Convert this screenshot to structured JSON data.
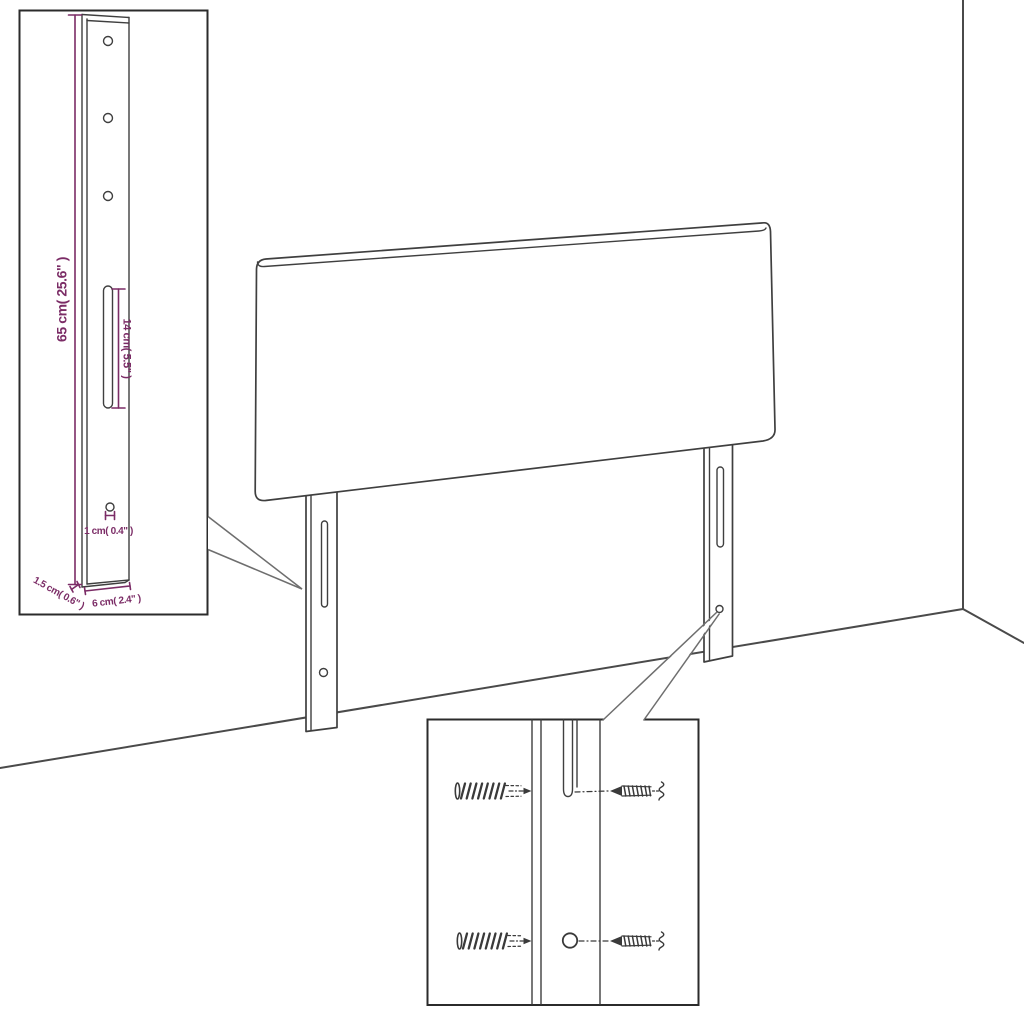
{
  "diagram": {
    "title": "headboard-with-mounting-legs-dimension-diagram",
    "colors": {
      "background": "#ffffff",
      "outline": "#3f3f3f",
      "dimension_text": "#7b2c66",
      "room_line": "#4a4a4a",
      "inset_border": "#2b2b2b",
      "callout_line": "#6e6e6e"
    },
    "leg_inset": {
      "height_label": "65 cm( 25.6\" )",
      "slot_label": "14 cm( 5.5\" )",
      "hole_label": "1 cm( 0.4\" )",
      "thickness_label": "1.5 cm( 0.6\" )",
      "width_label": "6 cm( 2.4\" )"
    },
    "hardware_inset": {
      "icons": [
        "wall-plug-icon",
        "screw-icon",
        "pilot-hole-icon",
        "slot-icon"
      ]
    }
  }
}
